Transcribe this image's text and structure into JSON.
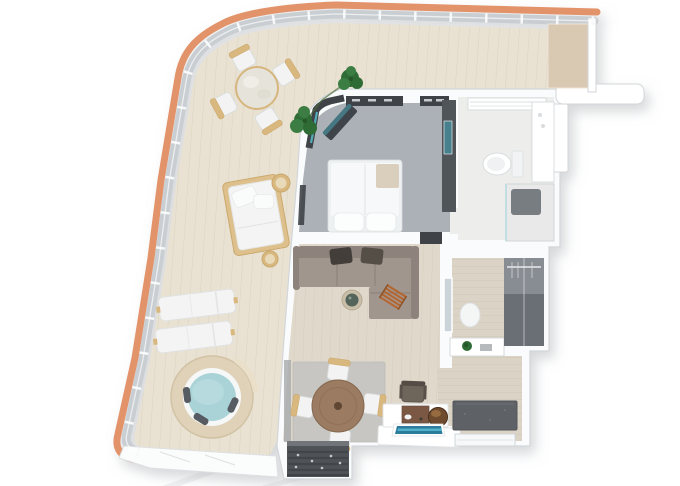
{
  "scene": {
    "type": "3d-floor-plan-top-down-rendering",
    "subject": "ship-suite-with-wraparound-balcony",
    "rooms": [
      {
        "name": "balcony-terrace"
      },
      {
        "name": "bedroom"
      },
      {
        "name": "bathroom"
      },
      {
        "name": "living-room"
      },
      {
        "name": "dining-area"
      },
      {
        "name": "dressing-room"
      },
      {
        "name": "entry-hall"
      },
      {
        "name": "entry-vestibule"
      }
    ],
    "balcony_items": [
      "orange-hull-edge",
      "glass-railing",
      "wood-deck",
      "round-patio-table",
      "patio-chairs-x4",
      "potted-plant",
      "daybed",
      "side-stools-x2",
      "sun-loungers-x2",
      "hot-tub",
      "privacy-partition"
    ],
    "interior_items": [
      "double-bed",
      "pillows",
      "wardrobe-strips",
      "tv-wall-unit",
      "tv-panel",
      "corner-glazing",
      "bench-glass-shelf",
      "vanity-shelf",
      "bathroom-counter",
      "toilet",
      "shower-tray",
      "mirror-panel",
      "stool",
      "plant-on-counter",
      "closet-unit",
      "sectional-sofa",
      "sofa-pillows",
      "ladder-throw",
      "round-side-table",
      "dining-rug",
      "round-dining-table",
      "dining-chairs-x4",
      "desk-chair",
      "desk",
      "bar-cabinet",
      "round-ice-bucket",
      "tv-screen",
      "door-mat",
      "entry-door"
    ]
  },
  "colors": {
    "hull": "#E2936A",
    "hullLight": "#F0AC80",
    "railing": "#C9CED2",
    "deck": "#E9E2D3",
    "deckLine": "#DDD4C1",
    "partition": "#D9C9B3",
    "wall": "#FAFBFC",
    "wallEdge": "#D2D6D9",
    "carpet": "#ABB1B6",
    "tile": "#EDEEEC",
    "wood": "#E0D9CB",
    "woodLine": "#D5CCBC",
    "hallwood": "#DBD3C5",
    "hallwoodLine": "#CEC5B5",
    "dark": "#3F4347",
    "unitDark": "#50555A",
    "closet": "#6A6F75",
    "closetLight": "#888D93",
    "entryDark": "#4F5357",
    "entryStripe": "#42464A",
    "sofa": "#A1968E",
    "sofaDark": "#8E837C",
    "pillow": "#433E39",
    "throwOrange": "#B5652F",
    "tableBrown": "#9B7B61",
    "tableBrownDark": "#5F4734",
    "chairWhite": "#F2F3F2",
    "chairTan": "#D9B87F",
    "tub": "#A9D3D7",
    "tubWood": "#E0D2B8",
    "plant": "#2F6B35",
    "plantDark": "#265629",
    "teal": "#47818D",
    "screenBlue": "#2E7C9C",
    "screenBlueLight": "#55B7D0",
    "mat": "#5E6266",
    "rug": "#C8C6C2",
    "cabinetBrown": "#7A5843",
    "stoolBrown": "#6E4A2E",
    "bedWhite": "#F6F8F9",
    "throwTan": "#D9CFBC",
    "shadowStreak": "#E3E6E8"
  }
}
